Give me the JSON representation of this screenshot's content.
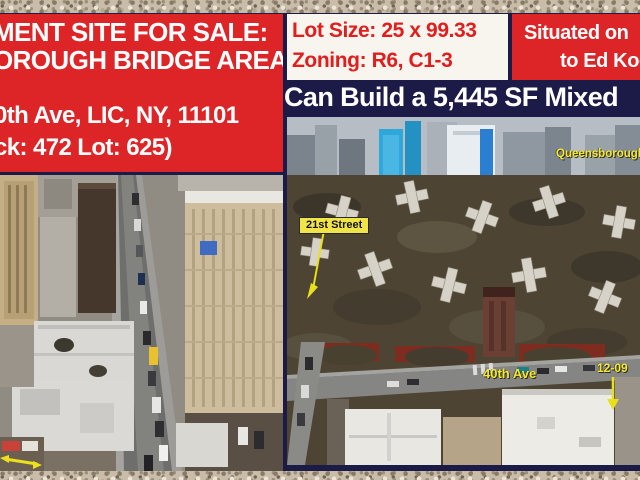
{
  "flyer": {
    "colors": {
      "background_navy": "#1c1a46",
      "banner_red": "#dd2527",
      "box_white": "#f8f5ef",
      "red_text": "#e21d1d",
      "label_yellow": "#f5e82e"
    },
    "left_banner": {
      "title_line1": "MENT SITE FOR SALE:",
      "title_line2": "OROUGH BRIDGE AREA",
      "address_line1": "0th Ave, LIC, NY, 11101",
      "address_line2": "ck: 472  Lot: 625)"
    },
    "lot_box": {
      "lot_size": "Lot Size: 25 x 99.33",
      "zoning": "Zoning: R6, C1-3"
    },
    "situated_box": {
      "line1": "Situated on",
      "line2": "to Ed Koc"
    },
    "build_bar": {
      "text": "Can Build a 5,445 SF Mixed"
    }
  },
  "photos": {
    "left": {
      "description": "aerial-street-view"
    },
    "right": {
      "description": "aerial-queensbridge-view",
      "labels": {
        "street_21st": "21st Street",
        "bridge": "Queensborough B",
        "ave_40th": "40th Ave",
        "lot_number": "12-09"
      }
    }
  }
}
